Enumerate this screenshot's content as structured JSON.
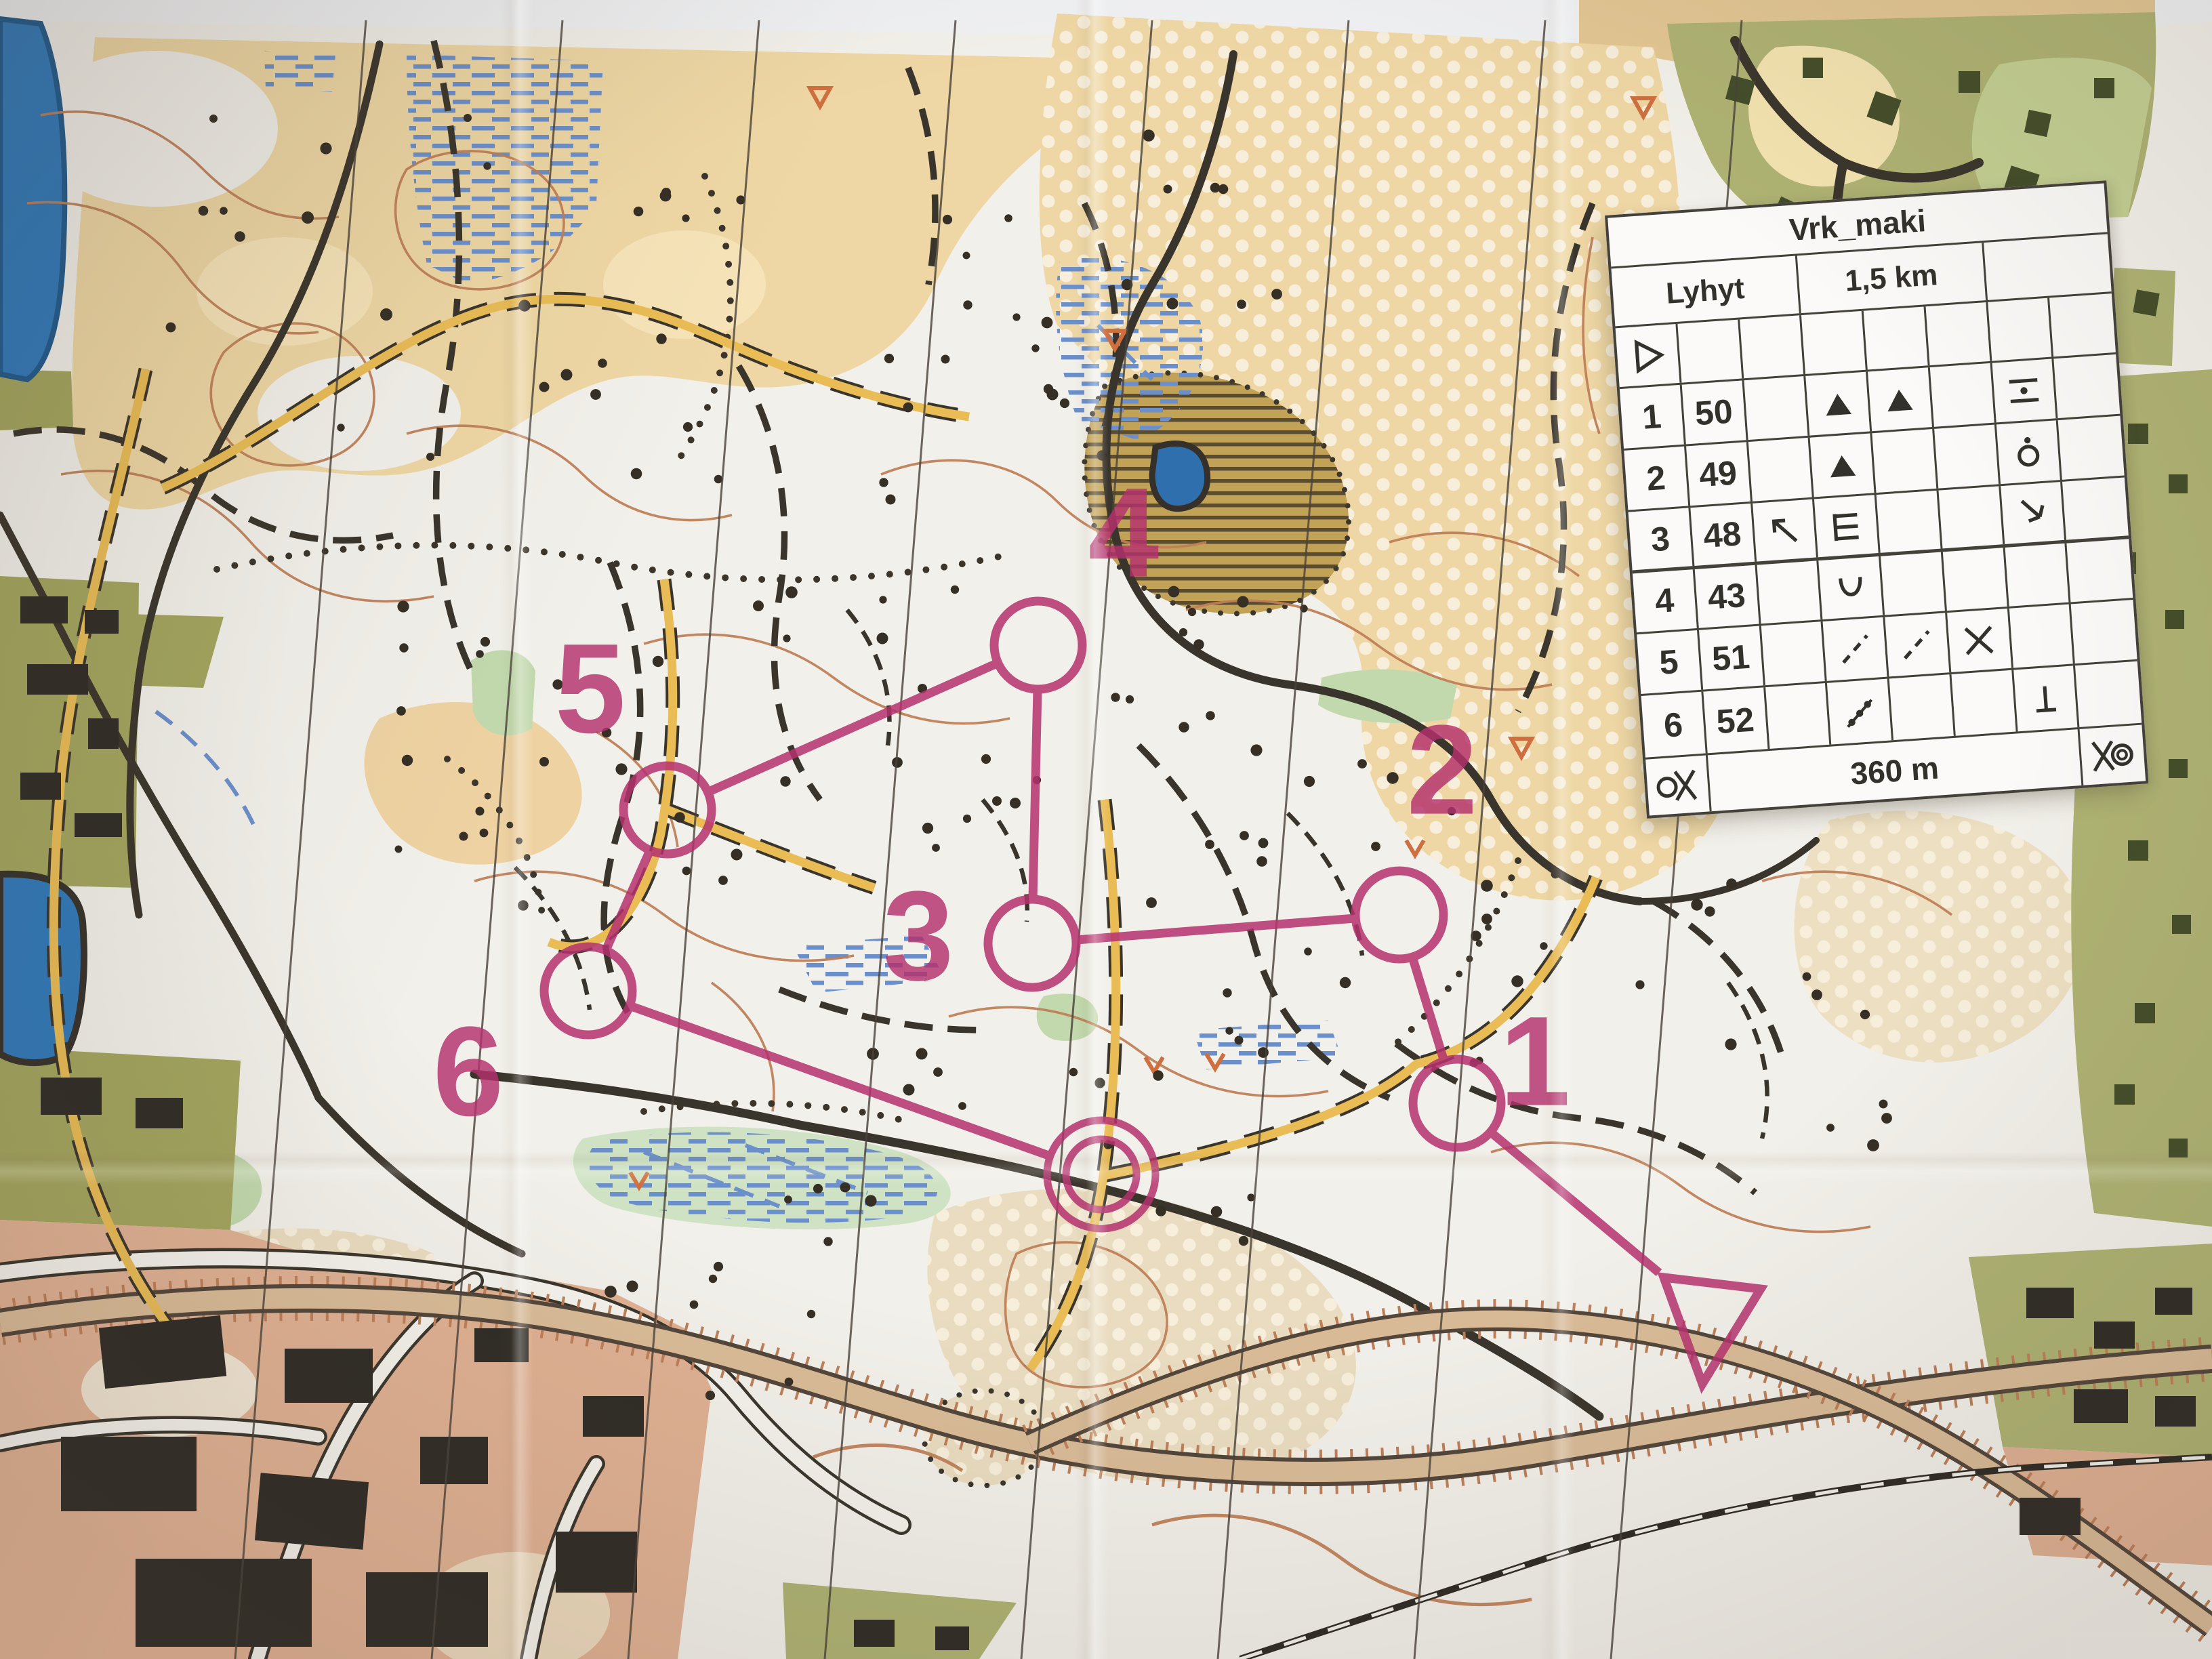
{
  "photo": {
    "subject": "orienteering course map on a table",
    "surface_color": "#e2c693",
    "paper_color": "#f2f0ea"
  },
  "map_course": {
    "color": "#b5316e",
    "control_numbers": [
      "1",
      "2",
      "3",
      "4",
      "5",
      "6"
    ],
    "labels": [
      {
        "text": "1"
      },
      {
        "text": "2"
      },
      {
        "text": "3"
      },
      {
        "text": "4"
      },
      {
        "text": "5"
      },
      {
        "text": "6"
      }
    ]
  },
  "control_sheet": {
    "title": "Vrk_maki",
    "course_name": "Lyhyt",
    "length": "1,5 km",
    "climb": "",
    "start_symbol": "start-triangle",
    "rows": [
      {
        "num": "1",
        "code": "50",
        "col_c": "",
        "col_d": "hill",
        "col_e": "hill",
        "col_f": "",
        "col_g": "between",
        "col_h": ""
      },
      {
        "num": "2",
        "code": "49",
        "col_c": "",
        "col_d": "hill",
        "col_e": "",
        "col_f": "",
        "col_g": "knoll-dot",
        "col_h": ""
      },
      {
        "num": "3",
        "code": "48",
        "col_c": "arrow-northwest",
        "col_d": "earth-bank",
        "col_e": "",
        "col_f": "",
        "col_g": "bend-southeast",
        "col_h": ""
      },
      {
        "num": "4",
        "code": "43",
        "col_c": "",
        "col_d": "reentrant",
        "col_e": "",
        "col_f": "",
        "col_g": "",
        "col_h": ""
      },
      {
        "num": "5",
        "code": "51",
        "col_c": "",
        "col_d": "path",
        "col_e": "path",
        "col_f": "crossing",
        "col_g": "",
        "col_h": ""
      },
      {
        "num": "6",
        "code": "52",
        "col_c": "",
        "col_d": "stone-wall",
        "col_e": "",
        "col_f": "",
        "col_g": "foot",
        "col_h": ""
      }
    ],
    "finish_row": {
      "left_symbol": "funnel-to-finish",
      "distance": "360 m",
      "right_symbol": "taped-route-finish"
    }
  }
}
